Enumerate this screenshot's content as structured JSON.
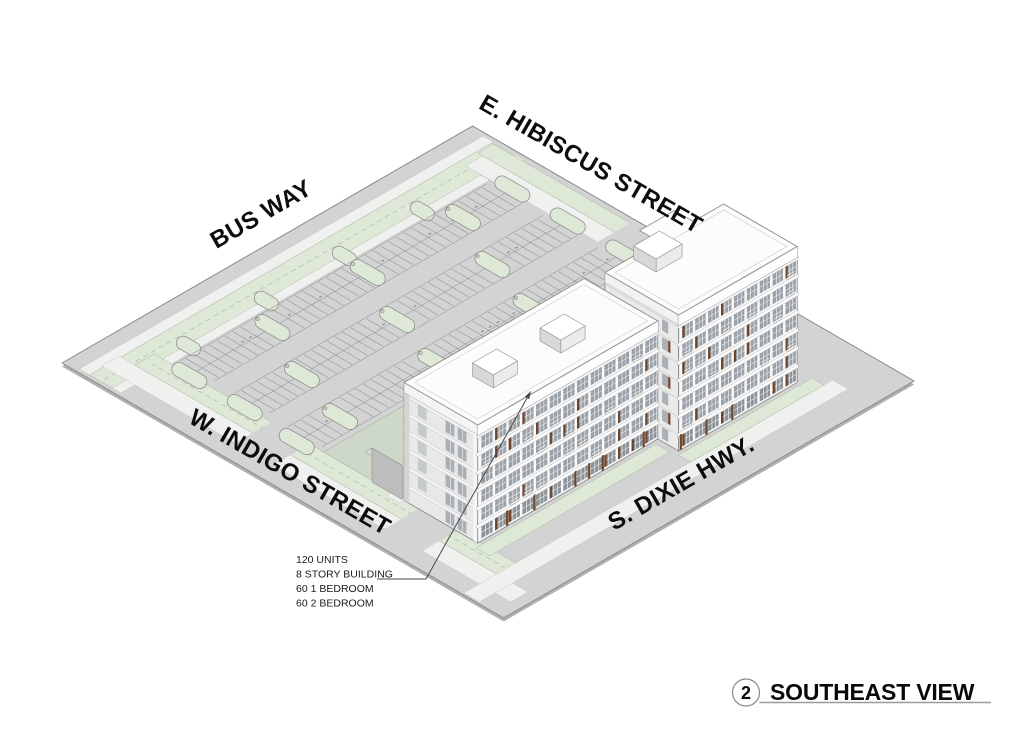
{
  "scene": {
    "description": "Isometric architectural site rendering of an apartment building with surface parking lot"
  },
  "streets": {
    "bus_way": "BUS WAY",
    "hibiscus": "E. HIBISCUS STREET",
    "indigo": "W. INDIGO STREET",
    "dixie": "S. DIXIE HWY."
  },
  "annotation": {
    "lines": [
      "120 UNITS",
      "8 STORY BUILDING",
      "60 1 BEDROOM",
      "60 2 BEDROOM"
    ]
  },
  "view_label": {
    "number": "2",
    "title": "SOUTHEAST VIEW"
  },
  "colors": {
    "background": "#ffffff",
    "pavement": "#d3d3d3",
    "pavement_shadow": "#b0b0b0",
    "pavement_edge": "#8a8a8a",
    "landscape_green": "#dde8d6",
    "sidewalk": "#f0f0ee",
    "facade_white": "#f7f7f7",
    "facade_shade": "#e8e8e8",
    "glass": "#9aa1a8",
    "glass_dark": "#8b9298",
    "wood_accent": "#6f4429",
    "roof": "#fcfcfc",
    "line_dark": "#4a4a4a",
    "title_line": "#9a9a9a",
    "text": "#111111"
  }
}
